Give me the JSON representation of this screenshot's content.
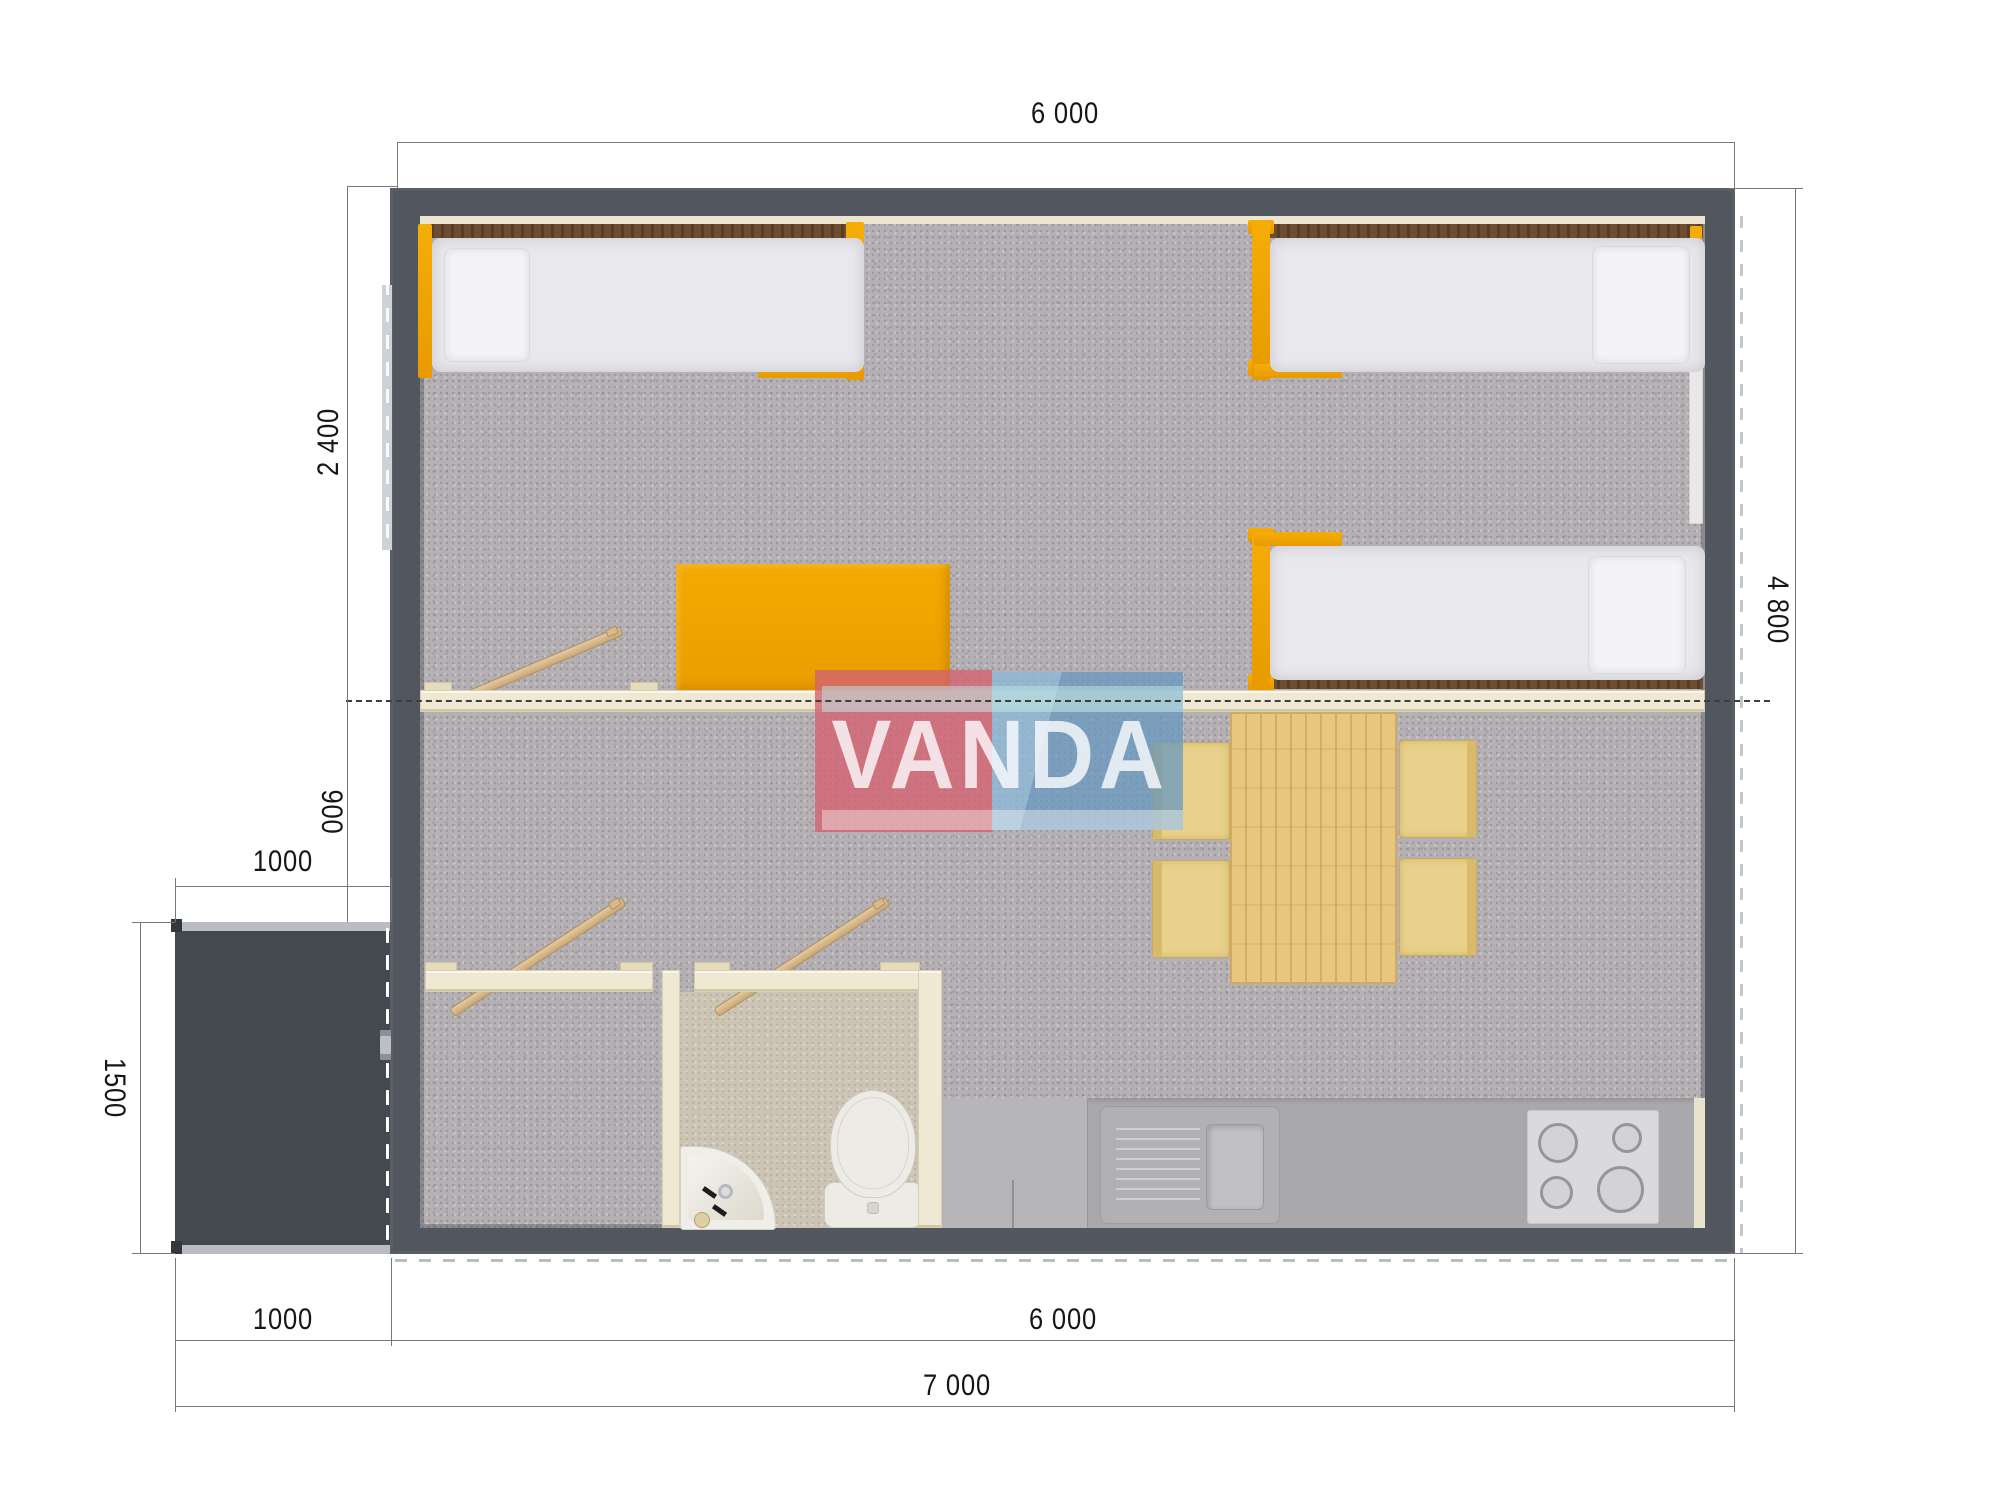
{
  "watermark": {
    "text": "VANDA"
  },
  "dimensions": {
    "top_width": "6 000",
    "bedroom_depth": "2 400",
    "hallway_depth": "900",
    "porch_width": "1000",
    "porch_depth": "1500",
    "house_depth": "4 800",
    "bottom_porch_width": "1000",
    "bottom_house_width": "6 000",
    "total_width": "7 000"
  },
  "colors": {
    "wall": "#51565f",
    "porch": "#44484f",
    "carpet": "#b5b0b4",
    "bathroom_floor": "#ccc4b5",
    "accent_orange": "#eda301",
    "cream_partition": "#efe8d2",
    "wood_table": "#e7c67f",
    "watermark_pink": "#d36371",
    "watermark_blue": "#6da0c5"
  },
  "fixtures": [
    "single-bed",
    "single-bed",
    "single-bed",
    "pillow",
    "desk",
    "coat-hook-rail",
    "dining-table",
    "chair",
    "chair",
    "chair",
    "chair",
    "wardrobe-room",
    "bathroom",
    "washbasin",
    "toilet",
    "kitchen-counter",
    "kitchen-sink",
    "stove",
    "entrance-porch",
    "entrance-door"
  ]
}
